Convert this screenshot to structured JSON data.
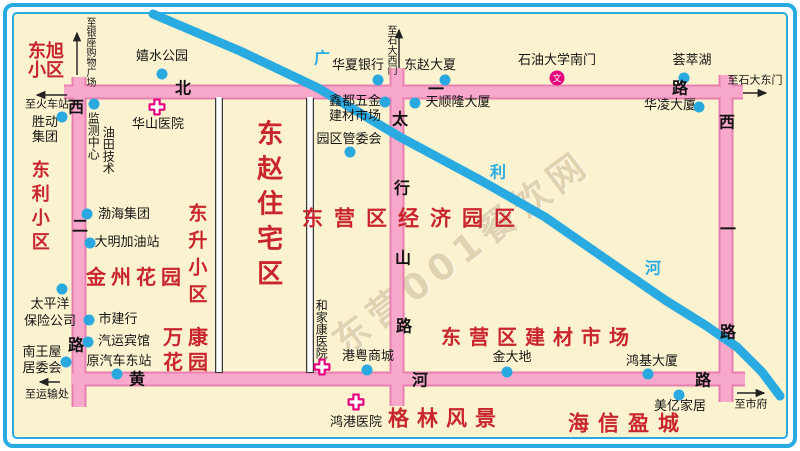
{
  "colors": {
    "frame_blue": "#29ABE2",
    "map_bg": "#FBF3D0",
    "road_fill": "#F7A8CB",
    "road_edge": "#E77FB0",
    "river_blue": "#29ABE2",
    "poi_dot_blue": "#29A9E0",
    "area_red": "#C9252C",
    "hospital_magenta": "#E6007E"
  },
  "watermark": "东营001餐饮网",
  "roads": {
    "beiyilu": [
      "北",
      "一",
      "路"
    ],
    "xierlu": [
      "西",
      "二",
      "路"
    ],
    "huanghelu": [
      "黄",
      "河",
      "路"
    ],
    "taihangshanlu": [
      "太",
      "行",
      "山",
      "路"
    ],
    "xiyilu": [
      "西",
      "一",
      "路"
    ]
  },
  "river": [
    "广",
    "利",
    "河"
  ],
  "areas": {
    "dongxu": [
      "东旭",
      "小区"
    ],
    "dongli": "东利小区",
    "jinzhou": "金州花园",
    "dongsheng": "东升小区",
    "wankang": [
      "万康",
      "花园"
    ],
    "dongzhao": "东赵住宅区",
    "jingji": "东营区经济园区",
    "jiancai": "东营区建材市场",
    "gelin": "格林风景",
    "haixin": "海信盈城"
  },
  "pois": {
    "xishui": "嬉水公园",
    "shengdong": [
      "胜动",
      "集团"
    ],
    "jiance": "监测中心",
    "youtian": "油田技术",
    "huashan": "华山医院",
    "huaxia": "华夏银行",
    "dongzhaodasha": "东赵大夏",
    "shiyou": "石油大学南门",
    "huicuihu": "荟萃湖",
    "hualing": "华凌大厦",
    "tianshunlong": "天顺隆大厦",
    "xindu": [
      "鑫都五金",
      "建材市场"
    ],
    "yuanqu": "园区管委会",
    "bohai": "渤海集团",
    "daming": "大明加油站",
    "taipingyang": [
      "太平洋",
      "保险公司"
    ],
    "shijianhang": "市建行",
    "qiyun": "汽运宾馆",
    "nanwangwu": [
      "南王屋",
      "居委会"
    ],
    "yuanqiche": "原汽车东站",
    "hejiakang": "和家康医院",
    "gangyue": "港粤商城",
    "jindadi": "金大地",
    "hongjidasha": "鸿基大厦",
    "meiyi": "美亿家居",
    "honggang": "鸿港医院"
  },
  "edges": {
    "yinzuo": "至银座购物广场",
    "huoche": "至火车站",
    "shidaximen": "至石大西门",
    "shidadongmen": "至石大东门",
    "yunshu": "至运输处",
    "shifu": "至市府"
  },
  "icons": {
    "school_char": "文"
  }
}
